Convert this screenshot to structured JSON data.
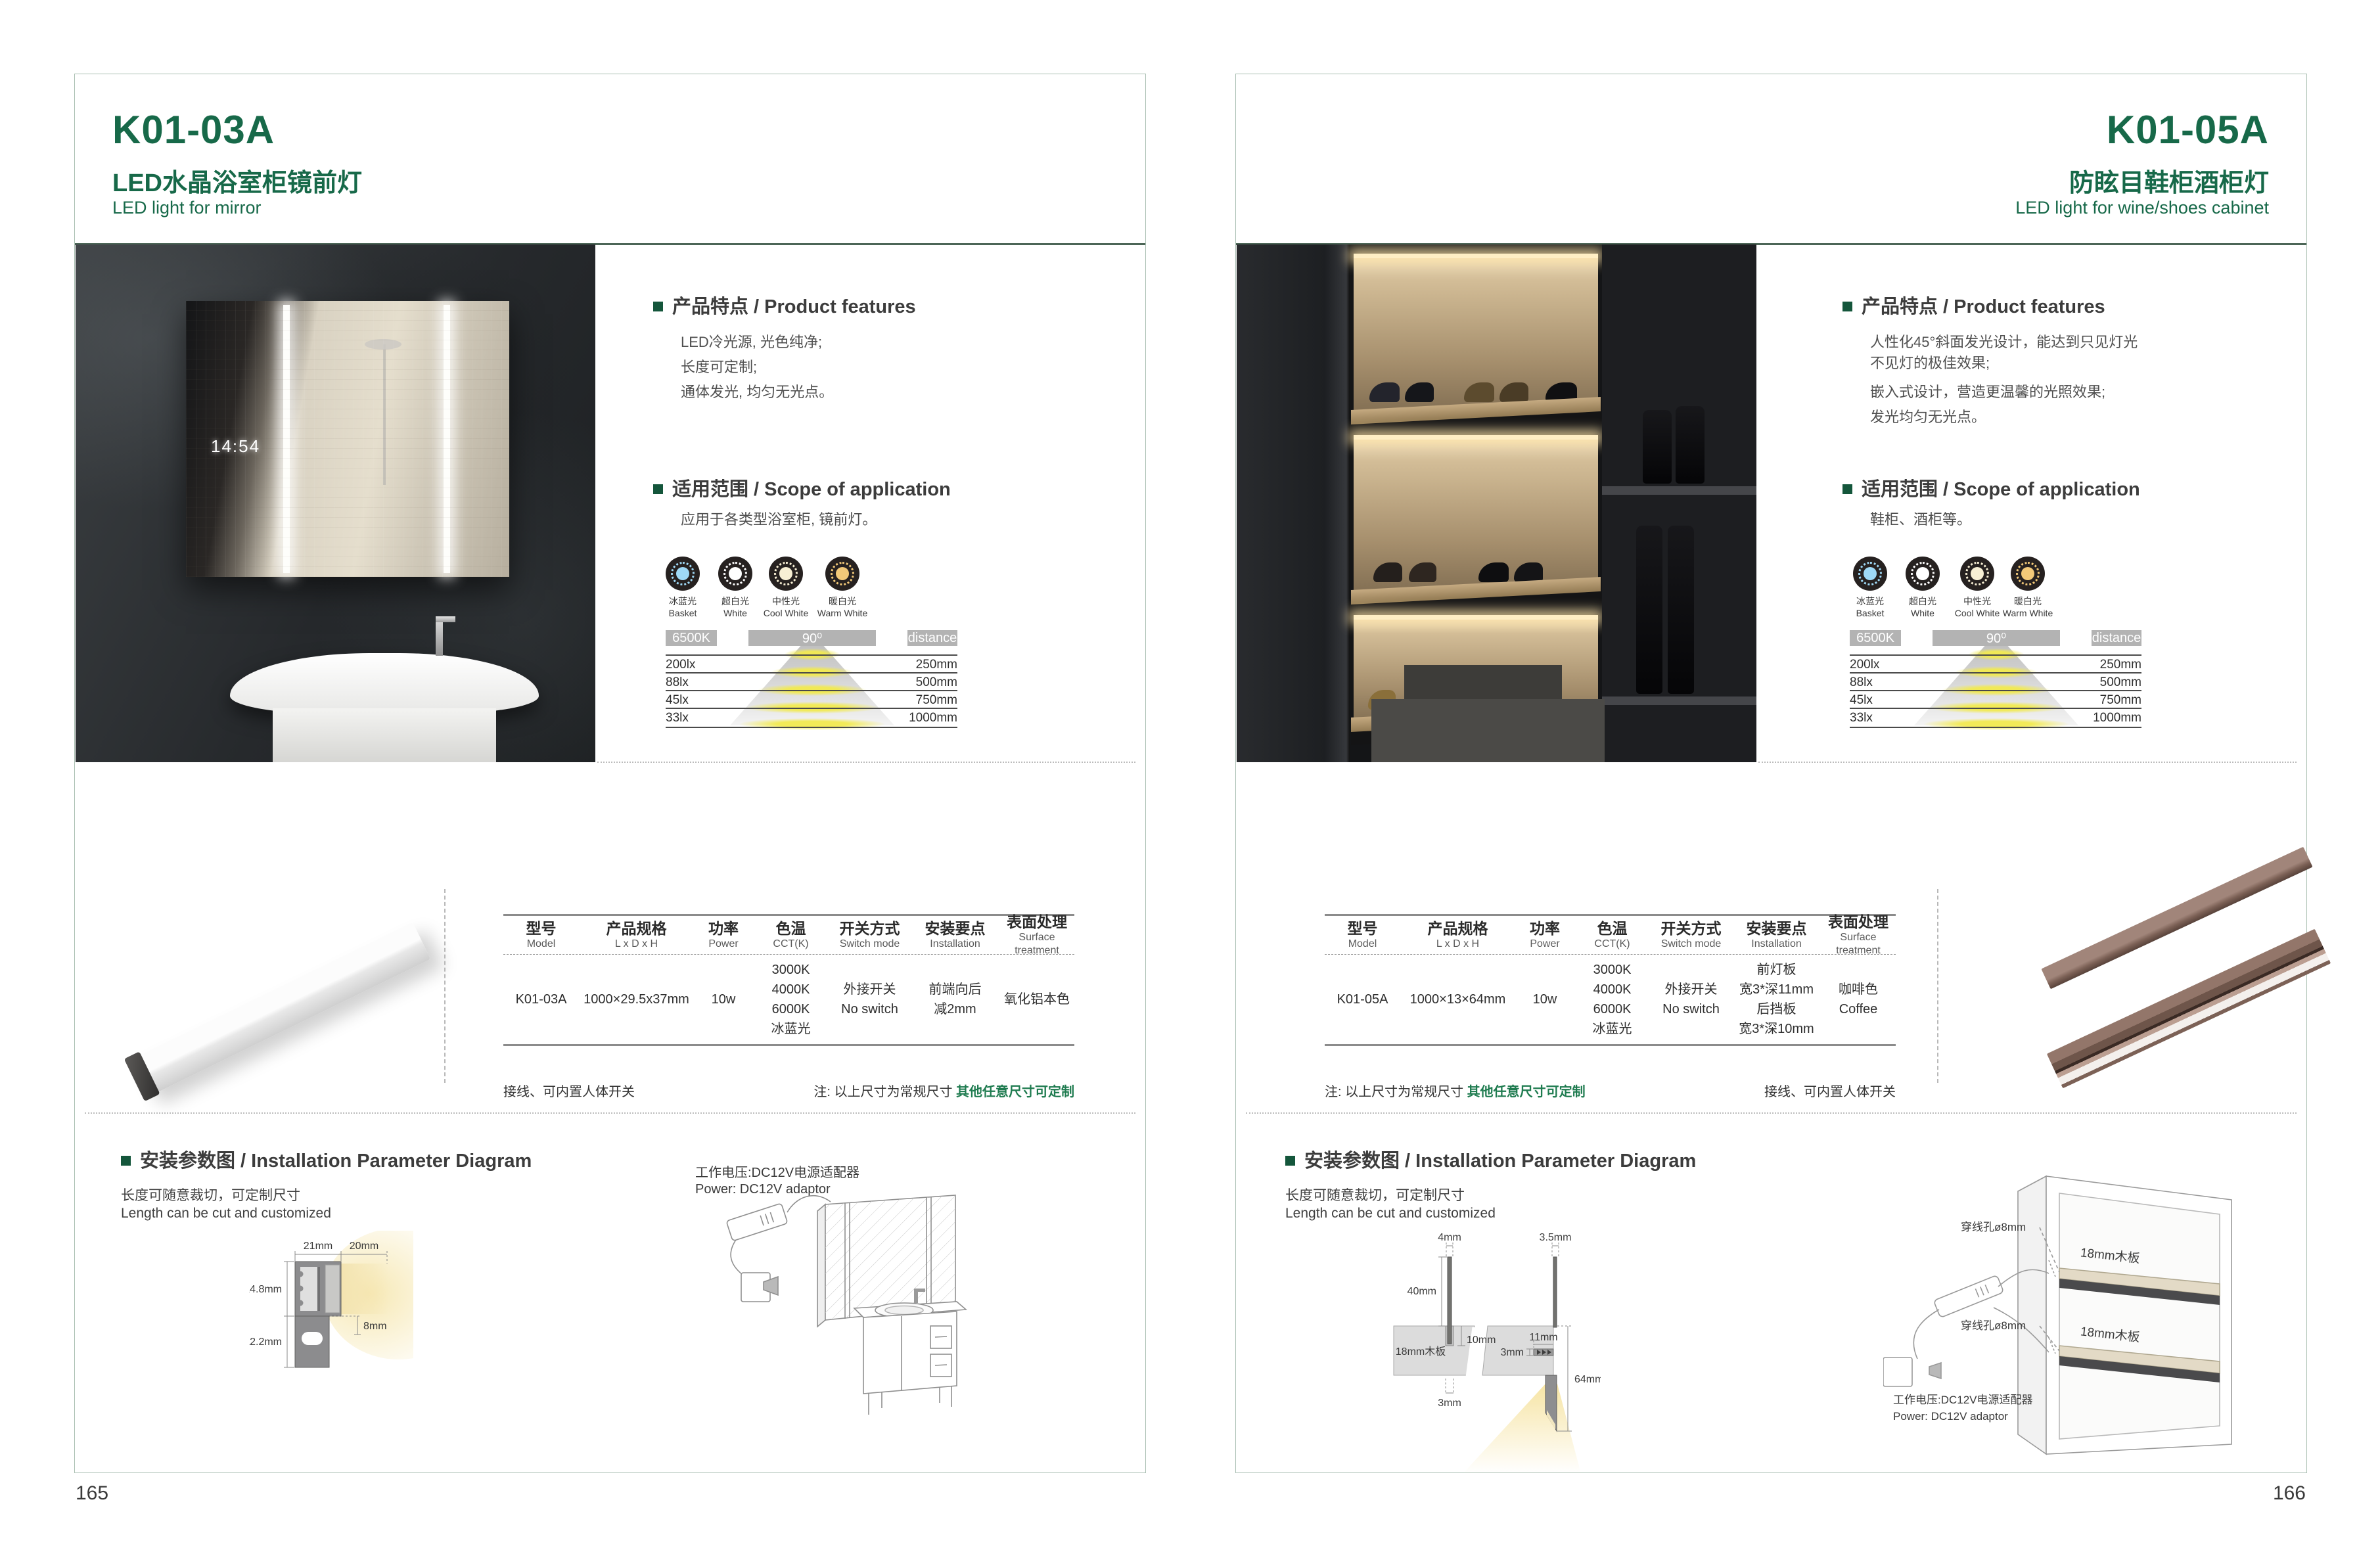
{
  "colors": {
    "accent_green": "#176949",
    "note_green": "#1e7b4f",
    "page_border": "#a9bfb2",
    "bar_grey": "#b3b3b3",
    "light_ice_blue": "#9fd9f6",
    "light_white": "#ffffff",
    "light_cool_white": "#f7efd4",
    "light_warm_white": "#f2c979"
  },
  "shared": {
    "features_header": "产品特点 / Product features",
    "scope_header": "适用范围 / Scope of application",
    "install_header": "安装参数图 / Installation Parameter Diagram",
    "cut_note_cn": "长度可随意裁切，可定制尺寸",
    "cut_note_en": "Length can be cut and customized",
    "power_note_cn": "工作电压:DC12V电源适配器",
    "power_note_en": "Power: DC12V adaptor",
    "wiring_note": "接线、可内置人体开关",
    "size_note_prefix": "注: 以上尺寸为常规尺寸 ",
    "size_note_green": "其他任意尺寸可定制",
    "lights": [
      {
        "cn": "冰蓝光",
        "en": "Basket",
        "color": "#9fd9f6"
      },
      {
        "cn": "超白光",
        "en": "White",
        "color": "#ffffff"
      },
      {
        "cn": "中性光",
        "en": "Cool White",
        "color": "#f7efd4"
      },
      {
        "cn": "暖白光",
        "en": "Warm White",
        "color": "#f2c979"
      }
    ],
    "beam": {
      "kelvin": "6500K",
      "angle": "90⁰",
      "distance": "distance",
      "rows": [
        {
          "lux": "200lx",
          "mm": "250mm"
        },
        {
          "lux": "88lx",
          "mm": "500mm"
        },
        {
          "lux": "45lx",
          "mm": "750mm"
        },
        {
          "lux": "33lx",
          "mm": "1000mm"
        }
      ]
    },
    "table_headers": [
      {
        "cn": "型号",
        "en": "Model"
      },
      {
        "cn": "产品规格",
        "en": "L x D x H"
      },
      {
        "cn": "功率",
        "en": "Power"
      },
      {
        "cn": "色温",
        "en": "CCT(K)"
      },
      {
        "cn": "开关方式",
        "en": "Switch mode"
      },
      {
        "cn": "安装要点",
        "en": "Installation"
      },
      {
        "cn": "表面处理",
        "en": "Surface treatment"
      }
    ]
  },
  "left": {
    "code": "K01-03A",
    "title_cn": "LED水晶浴室柜镜前灯",
    "title_en": "LED light for mirror",
    "features": {
      "p1": "LED冷光源, 光色纯净;",
      "p2": "长度可定制;",
      "p3": "通体发光, 均匀无光点。"
    },
    "scope": "应用于各类型浴室柜, 镜前灯。",
    "photo_clock": "14:54",
    "row": {
      "model": "K01-03A",
      "size": "1000×29.5x37mm",
      "power": "10w",
      "cct": [
        "3000K",
        "4000K",
        "6000K",
        "冰蓝光"
      ],
      "switch": [
        "外接开关",
        "No switch"
      ],
      "install": [
        "前端向后",
        "减2mm"
      ],
      "surface": [
        "氧化铝本色"
      ]
    },
    "dims": {
      "w21": "21mm",
      "w20": "20mm",
      "h148": "14.8mm",
      "h122": "12.2mm",
      "h8": "8mm"
    },
    "page_number": "165"
  },
  "right": {
    "code": "K01-05A",
    "title_cn": "防眩目鞋柜酒柜灯",
    "title_en": "LED light for wine/shoes cabinet",
    "features": {
      "p1a": "人性化45°斜面发光设计，能达到只见灯光",
      "p1b": "不见灯的极佳效果;",
      "p2": "嵌入式设计，营造更温馨的光照效果;",
      "p3": "发光均匀无光点。"
    },
    "scope": "鞋柜、酒柜等。",
    "row": {
      "model": "K01-05A",
      "size": "1000×13×64mm",
      "power": "10w",
      "cct": [
        "3000K",
        "4000K",
        "6000K",
        "冰蓝光"
      ],
      "switch": [
        "外接开关",
        "No switch"
      ],
      "install": [
        "前灯板",
        "宽3*深11mm",
        "后挡板",
        "宽3*深10mm"
      ],
      "surface": [
        "咖啡色",
        "Coffee"
      ]
    },
    "dims": {
      "d4": "4mm",
      "d35": "3.5mm",
      "d40": "40mm",
      "board": "18mm木板",
      "d10": "10mm",
      "d3a": "3mm",
      "d11": "11mm",
      "d3b": "3mm",
      "d64": "64mm"
    },
    "cabinet": {
      "hole1": "穿线孔ø8mm",
      "hole2": "穿线孔ø8mm",
      "board1": "18mm木板",
      "board2": "18mm木板"
    },
    "page_number": "166"
  }
}
